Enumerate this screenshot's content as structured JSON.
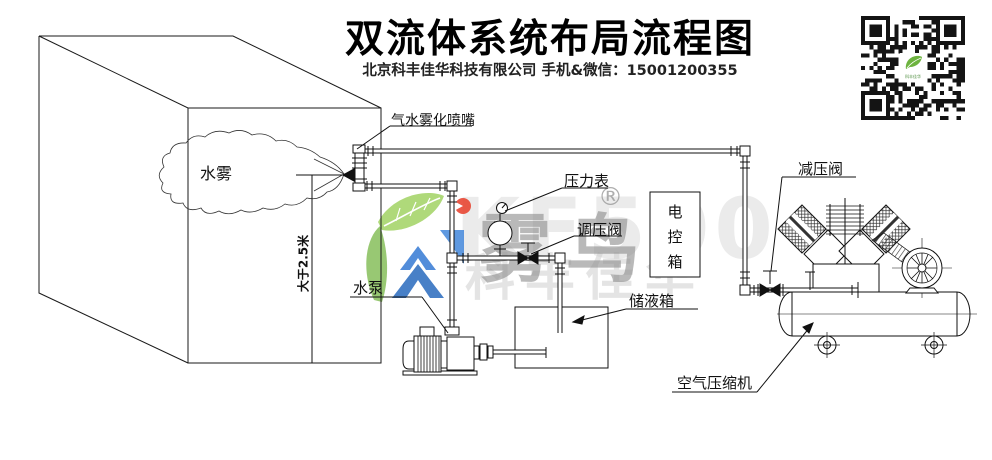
{
  "header": {
    "title": "双流体系统布局流程图",
    "subtitle": "北京科丰佳华科技有限公司 手机&微信：15001200355"
  },
  "diagram": {
    "labels": {
      "nozzle": "气水雾化喷嘴",
      "mist": "水雾",
      "height_dim": "大于2.5米",
      "pressure_gauge": "压力表",
      "regulating_valve": "调压阀",
      "water_pump": "水泵",
      "liquid_tank": "储液箱",
      "control_box": "电控箱",
      "control_box_chars": {
        "c1": "电",
        "c2": "控",
        "c3": "箱"
      },
      "reducing_valve": "减压阀",
      "air_compressor": "空气压缩机"
    }
  },
  "watermark": {
    "brand_cn": "雾鸟",
    "brand_model": "KF500",
    "company": "科丰佳华",
    "registered_mark": "®",
    "colors": {
      "leaf_green": "#8dc63f",
      "logo_blue": "#2f6fc0",
      "accent_red": "#e8432f",
      "text_gray": "#8f8f8f"
    }
  },
  "icons": {
    "qr_code": "wechat-qr-code",
    "leaf_logo": "leaf-logo"
  }
}
